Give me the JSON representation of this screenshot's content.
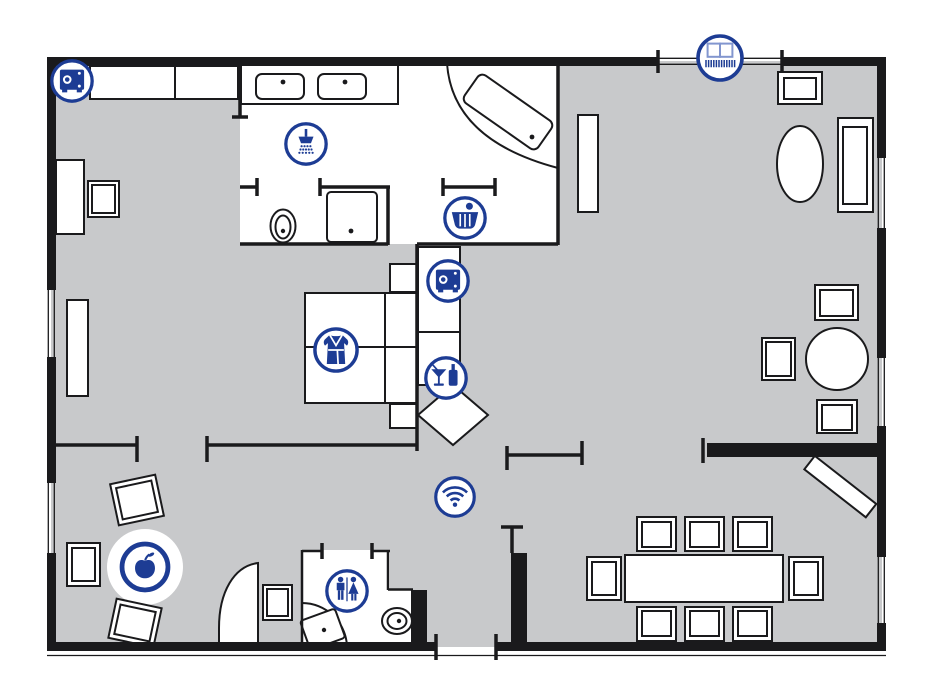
{
  "meta": {
    "title": "Hotel suite floor plan",
    "type": "floor-plan",
    "canvas": {
      "width": 933,
      "height": 700
    }
  },
  "palette": {
    "icon_blue": "#1d3c94",
    "icon_blue_light": "#8296cf",
    "floor_gray": "#c8c9cb",
    "wall_black": "#1a1a1c",
    "room_white": "#ffffff"
  },
  "icons": [
    {
      "id": "safe",
      "name": "safe-icon",
      "label": "in-room safe",
      "x": 72,
      "y": 81,
      "r": 22
    },
    {
      "id": "shower",
      "name": "shower-icon",
      "label": "shower",
      "x": 306,
      "y": 144,
      "r": 22
    },
    {
      "id": "bathtub",
      "name": "bathtub-icon",
      "label": "bathtub",
      "x": 465,
      "y": 218,
      "r": 22
    },
    {
      "id": "safe",
      "name": "safe-icon",
      "label": "in-room safe",
      "x": 448,
      "y": 281,
      "r": 22
    },
    {
      "id": "bathrobe",
      "name": "bathrobe-icon",
      "label": "bathrobe",
      "x": 336,
      "y": 350,
      "r": 23
    },
    {
      "id": "minibar",
      "name": "minibar-icon",
      "label": "minibar",
      "x": 446,
      "y": 378,
      "r": 22
    },
    {
      "id": "wifi",
      "name": "wifi-icon",
      "label": "wifi",
      "x": 455,
      "y": 497,
      "r": 21
    },
    {
      "id": "restroom",
      "name": "guest-wc-icon",
      "label": "guest wc",
      "x": 347,
      "y": 591,
      "r": 22
    },
    {
      "id": "fruit",
      "name": "fruit-icon",
      "label": "fruit basket",
      "x": 145,
      "y": 567,
      "r": 26
    },
    {
      "id": "balcony",
      "name": "balcony-icon",
      "label": "balcony",
      "x": 720,
      "y": 58,
      "r": 24
    }
  ]
}
